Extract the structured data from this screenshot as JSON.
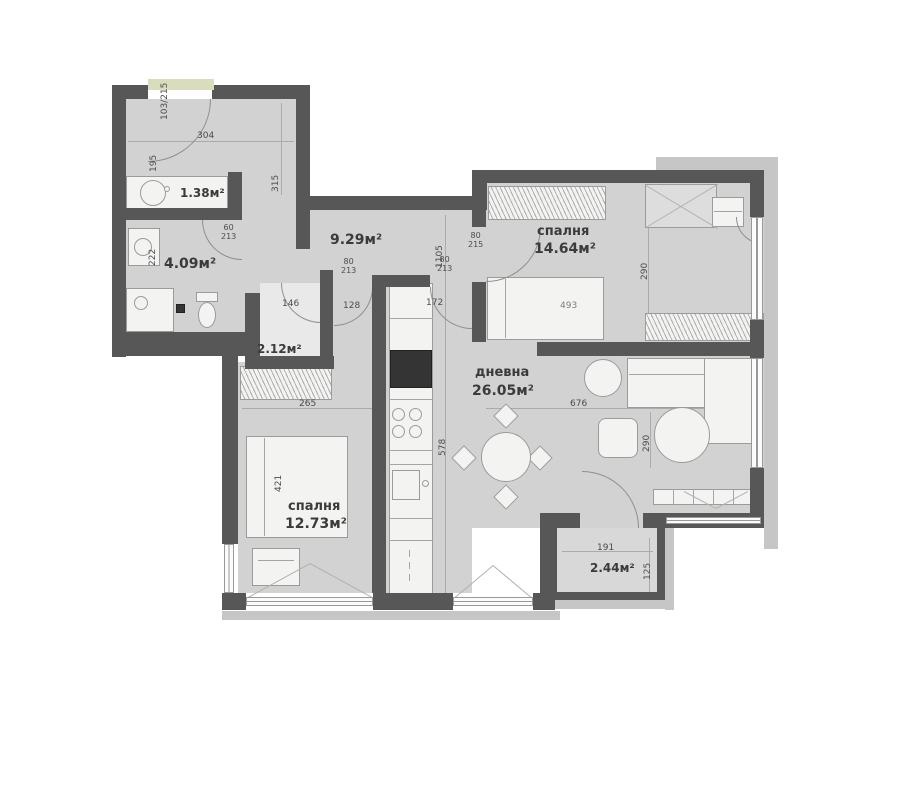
{
  "rooms": {
    "wc": {
      "area": "1.38м²"
    },
    "bathroom": {
      "area": "4.09м²"
    },
    "hallway": {
      "area": "9.29м²"
    },
    "bedroom_right": {
      "name": "спалня",
      "area": "14.64м²"
    },
    "closet": {
      "area": "2.12м²"
    },
    "living": {
      "name": "дневна",
      "area": "26.05м²"
    },
    "bedroom_left": {
      "name": "спалня",
      "area": "12.73м²"
    },
    "balcony": {
      "area": "2.44м²"
    }
  },
  "dims": {
    "entry_door": "103/215",
    "d304": "304",
    "d195": "195",
    "d315": "315",
    "d222": "222",
    "wc_door_w": "60",
    "wc_door_h": "213",
    "d1105": "1105",
    "bed1_door_w": "80",
    "bed1_door_h": "215",
    "door_a_w": "80",
    "door_a_h": "213",
    "door_b_w": "80",
    "door_b_h": "213",
    "d146": "146",
    "d128": "128",
    "d172": "172",
    "d493": "493",
    "d290a": "290",
    "d265": "265",
    "d676": "676",
    "d290b": "290",
    "d578": "578",
    "d421": "421",
    "d191": "191",
    "d125": "125"
  },
  "colors": {
    "wall": "#575757",
    "floor": "#d2d2d2",
    "outer_band": "#c6c6c6",
    "entry_band": "#d9dcbd"
  }
}
